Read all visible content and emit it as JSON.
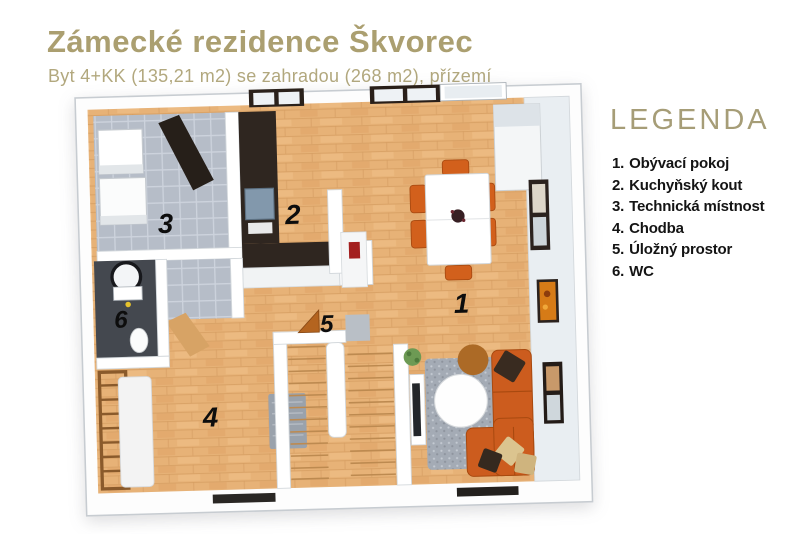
{
  "header": {
    "title": "Zámecké rezidence Škvorec",
    "subtitle": "Byt 4+KK (135,21 m2) se zahradou (268 m2), přízemí"
  },
  "legend": {
    "title": "LEGENDA",
    "items": [
      {
        "number": "1.",
        "label": "Obývací pokoj"
      },
      {
        "number": "2.",
        "label": "Kuchyňský kout"
      },
      {
        "number": "3.",
        "label": "Technická místnost"
      },
      {
        "number": "4.",
        "label": "Chodba"
      },
      {
        "number": "5.",
        "label": "Úložný prostor"
      },
      {
        "number": "6.",
        "label": "WC"
      }
    ]
  },
  "floorplan": {
    "labels": {
      "living": "1",
      "kitchen": "2",
      "technical": "3",
      "hallway": "4",
      "storage": "5",
      "wc": "6"
    },
    "colors": {
      "title_gold": "#ab9f70",
      "wood_floor": "#e7b277",
      "tile_floor": "#b6bdc8",
      "wc_floor": "#44484f",
      "kitchen_cabinets": "#2f2620",
      "sofa_orange": "#cc5c1e",
      "rug_gray": "#a4abb5",
      "wall_white": "#ffffff"
    }
  }
}
